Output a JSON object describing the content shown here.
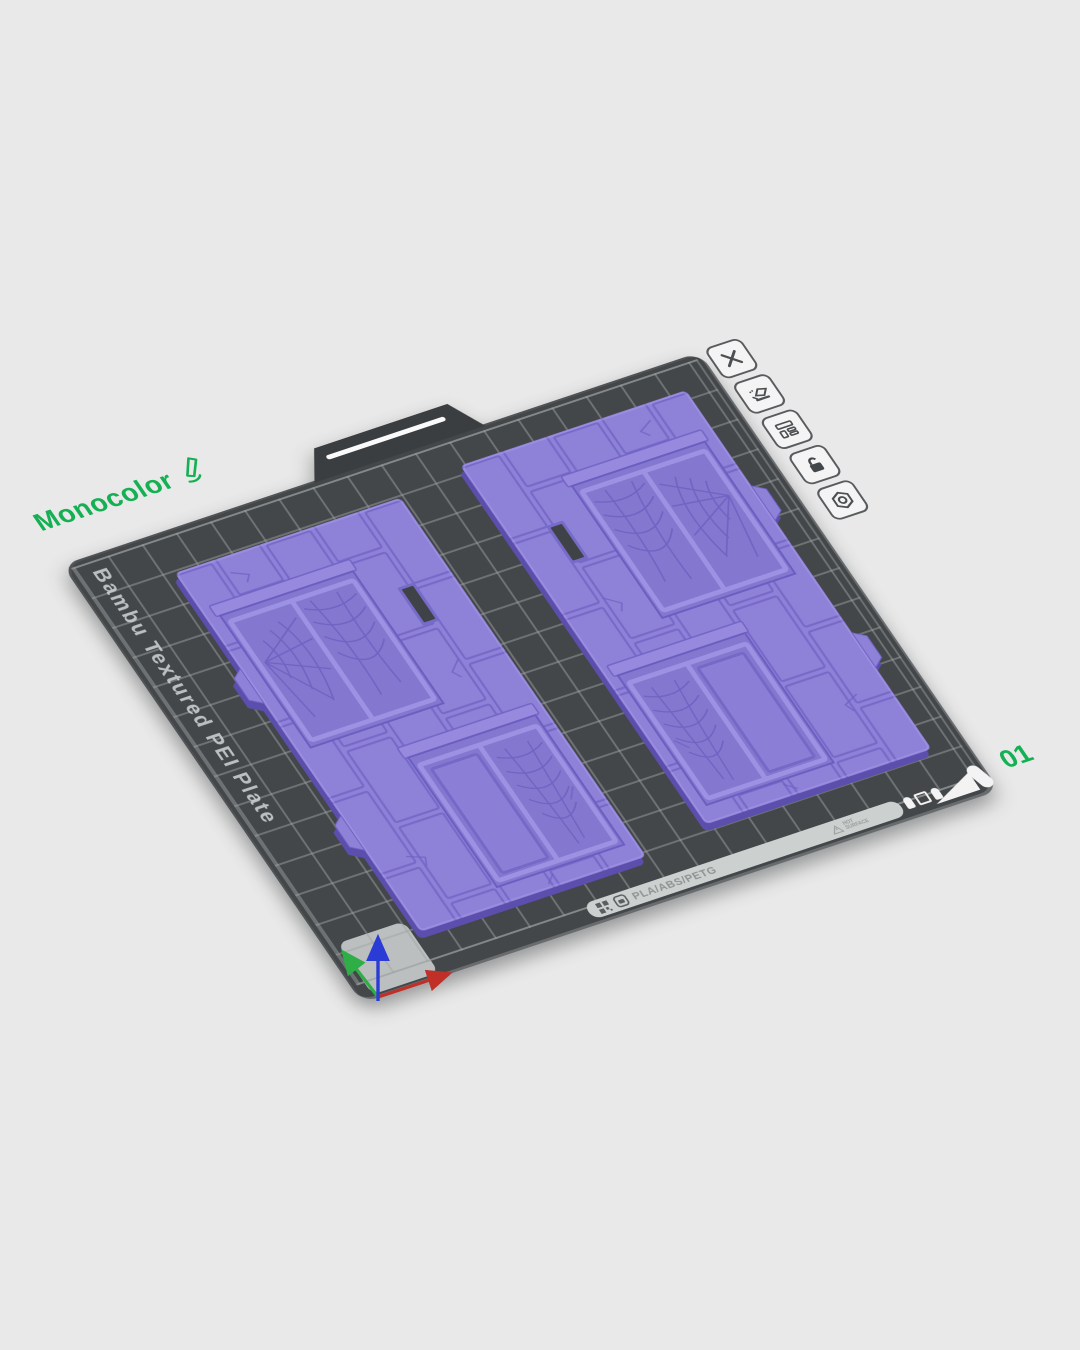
{
  "plate": {
    "label": "Monocolor",
    "number": "01",
    "type_text": "Bambu Textured PEI Plate",
    "materials_text": "PLA/ABS/PETG",
    "warning_line1": "HOT",
    "warning_line2": "SURFACE"
  },
  "toolbar": {
    "buttons": [
      {
        "name": "delete-plate",
        "icon": "close-icon"
      },
      {
        "name": "plate-edit",
        "icon": "plate-brush-icon"
      },
      {
        "name": "plate-layout",
        "icon": "plate-layout-icon"
      },
      {
        "name": "plate-lock",
        "icon": "unlock-icon"
      },
      {
        "name": "plate-settings",
        "icon": "nut-icon"
      }
    ]
  },
  "models": [
    {
      "name": "dungeon-tile-left",
      "color": "#8e81d8"
    },
    {
      "name": "dungeon-tile-right",
      "color": "#8e81d8"
    }
  ],
  "axes": {
    "x_color": "#c03028",
    "y_color": "#2fae47",
    "z_color": "#2b3bd6"
  },
  "colors": {
    "background": "#e9e9e9",
    "plate": "#44474a",
    "grid_line": "#9ea2a2",
    "accent_green": "#16b054",
    "model_purple": "#8e81d8"
  }
}
